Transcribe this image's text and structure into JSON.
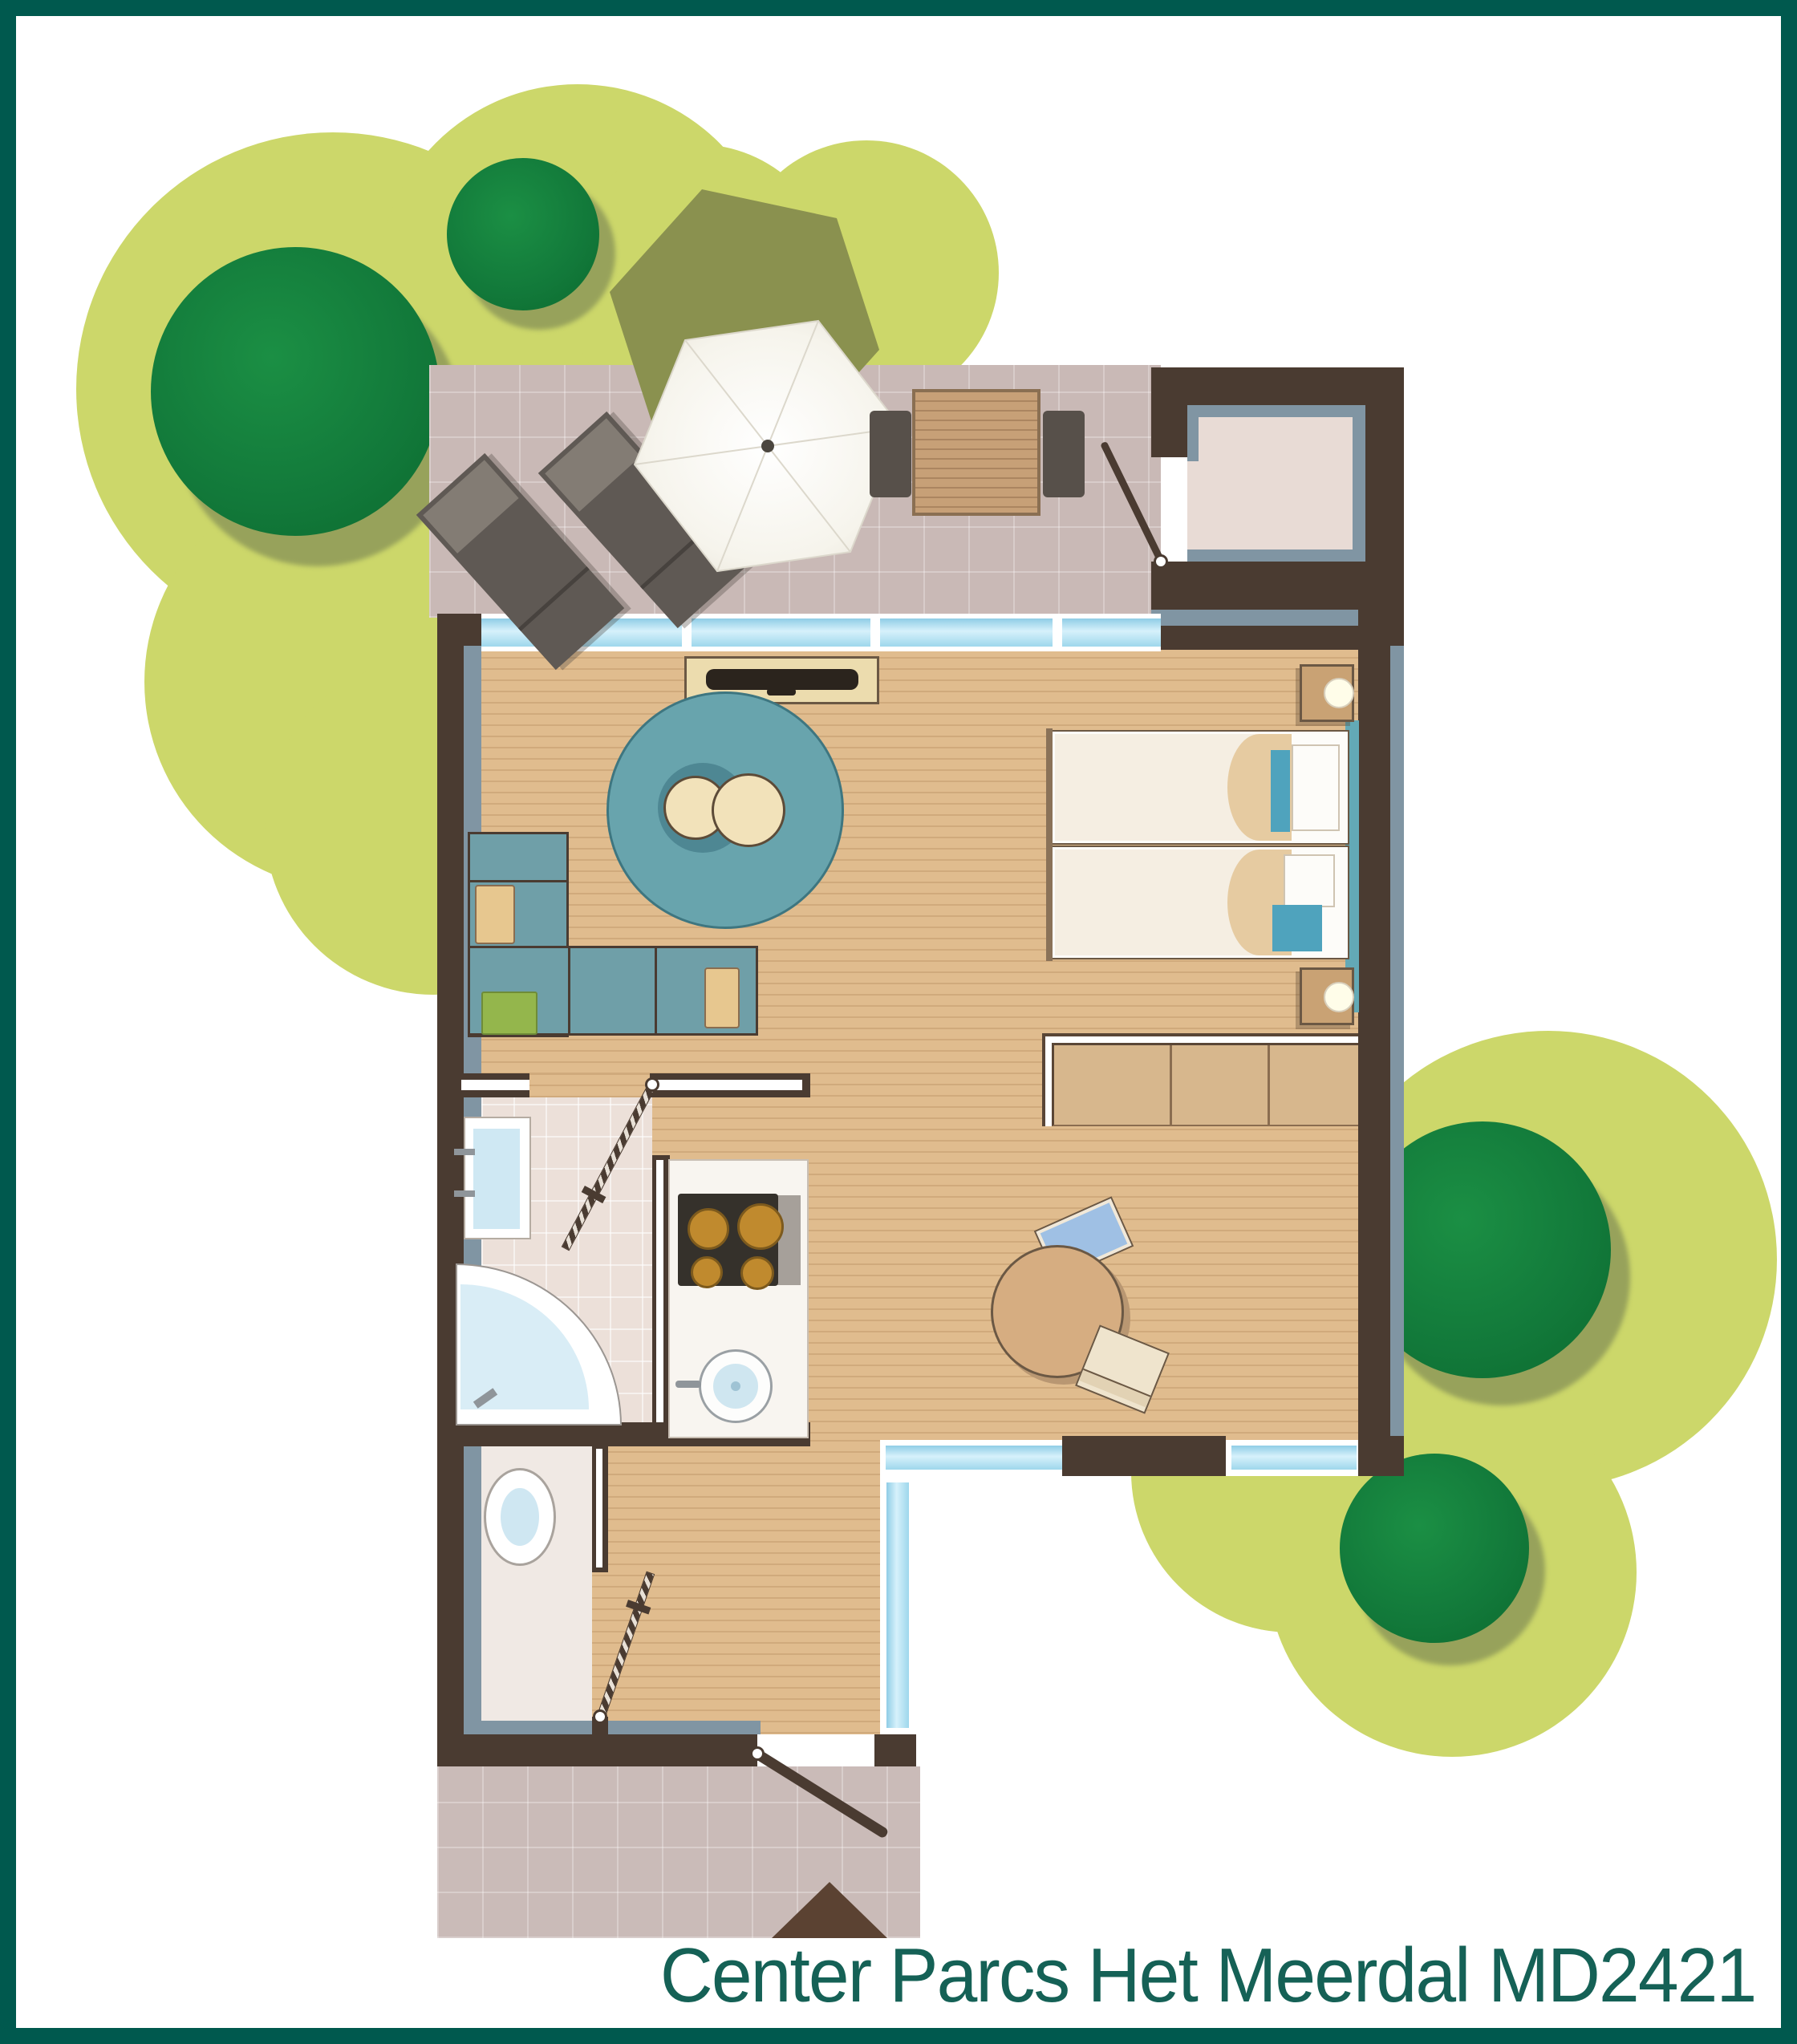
{
  "title": {
    "text": "Center Parcs Het Meerdal MD2421",
    "color": "#156156"
  },
  "palette": {
    "frame_border": "#00594e",
    "grass": "#ccd76a",
    "tree_green": "#12793a",
    "tree_shadow": "#97a25b",
    "terrace_tile": "#c9b9b6",
    "wall_brown": "#4a3b31",
    "wall_liner_blue_gray": "#8095a3",
    "window_glass": "#bfe6f6",
    "wood_floor": "#e0bc8e",
    "bathroom_tile": "#ece0d9",
    "rug_teal": "#68a4ad",
    "sofa_teal": "#6f9fa8",
    "cushion_tan": "#e7c78f",
    "cushion_green": "#94b64c",
    "bed_duvet": "#f5eee2",
    "bed_accent_teal": "#4fa3bd",
    "furniture_tan": "#d6ad81",
    "counter_white": "#f8f5f0",
    "burner_amber": "#c08a2e",
    "water_blue": "#d9edf6",
    "umbrella_white": "#fbfaf6",
    "umbrella_shade_olive": "#8a914f",
    "lounger_gray": "#5f5954",
    "door_triangle_brown": "#5b4232"
  }
}
